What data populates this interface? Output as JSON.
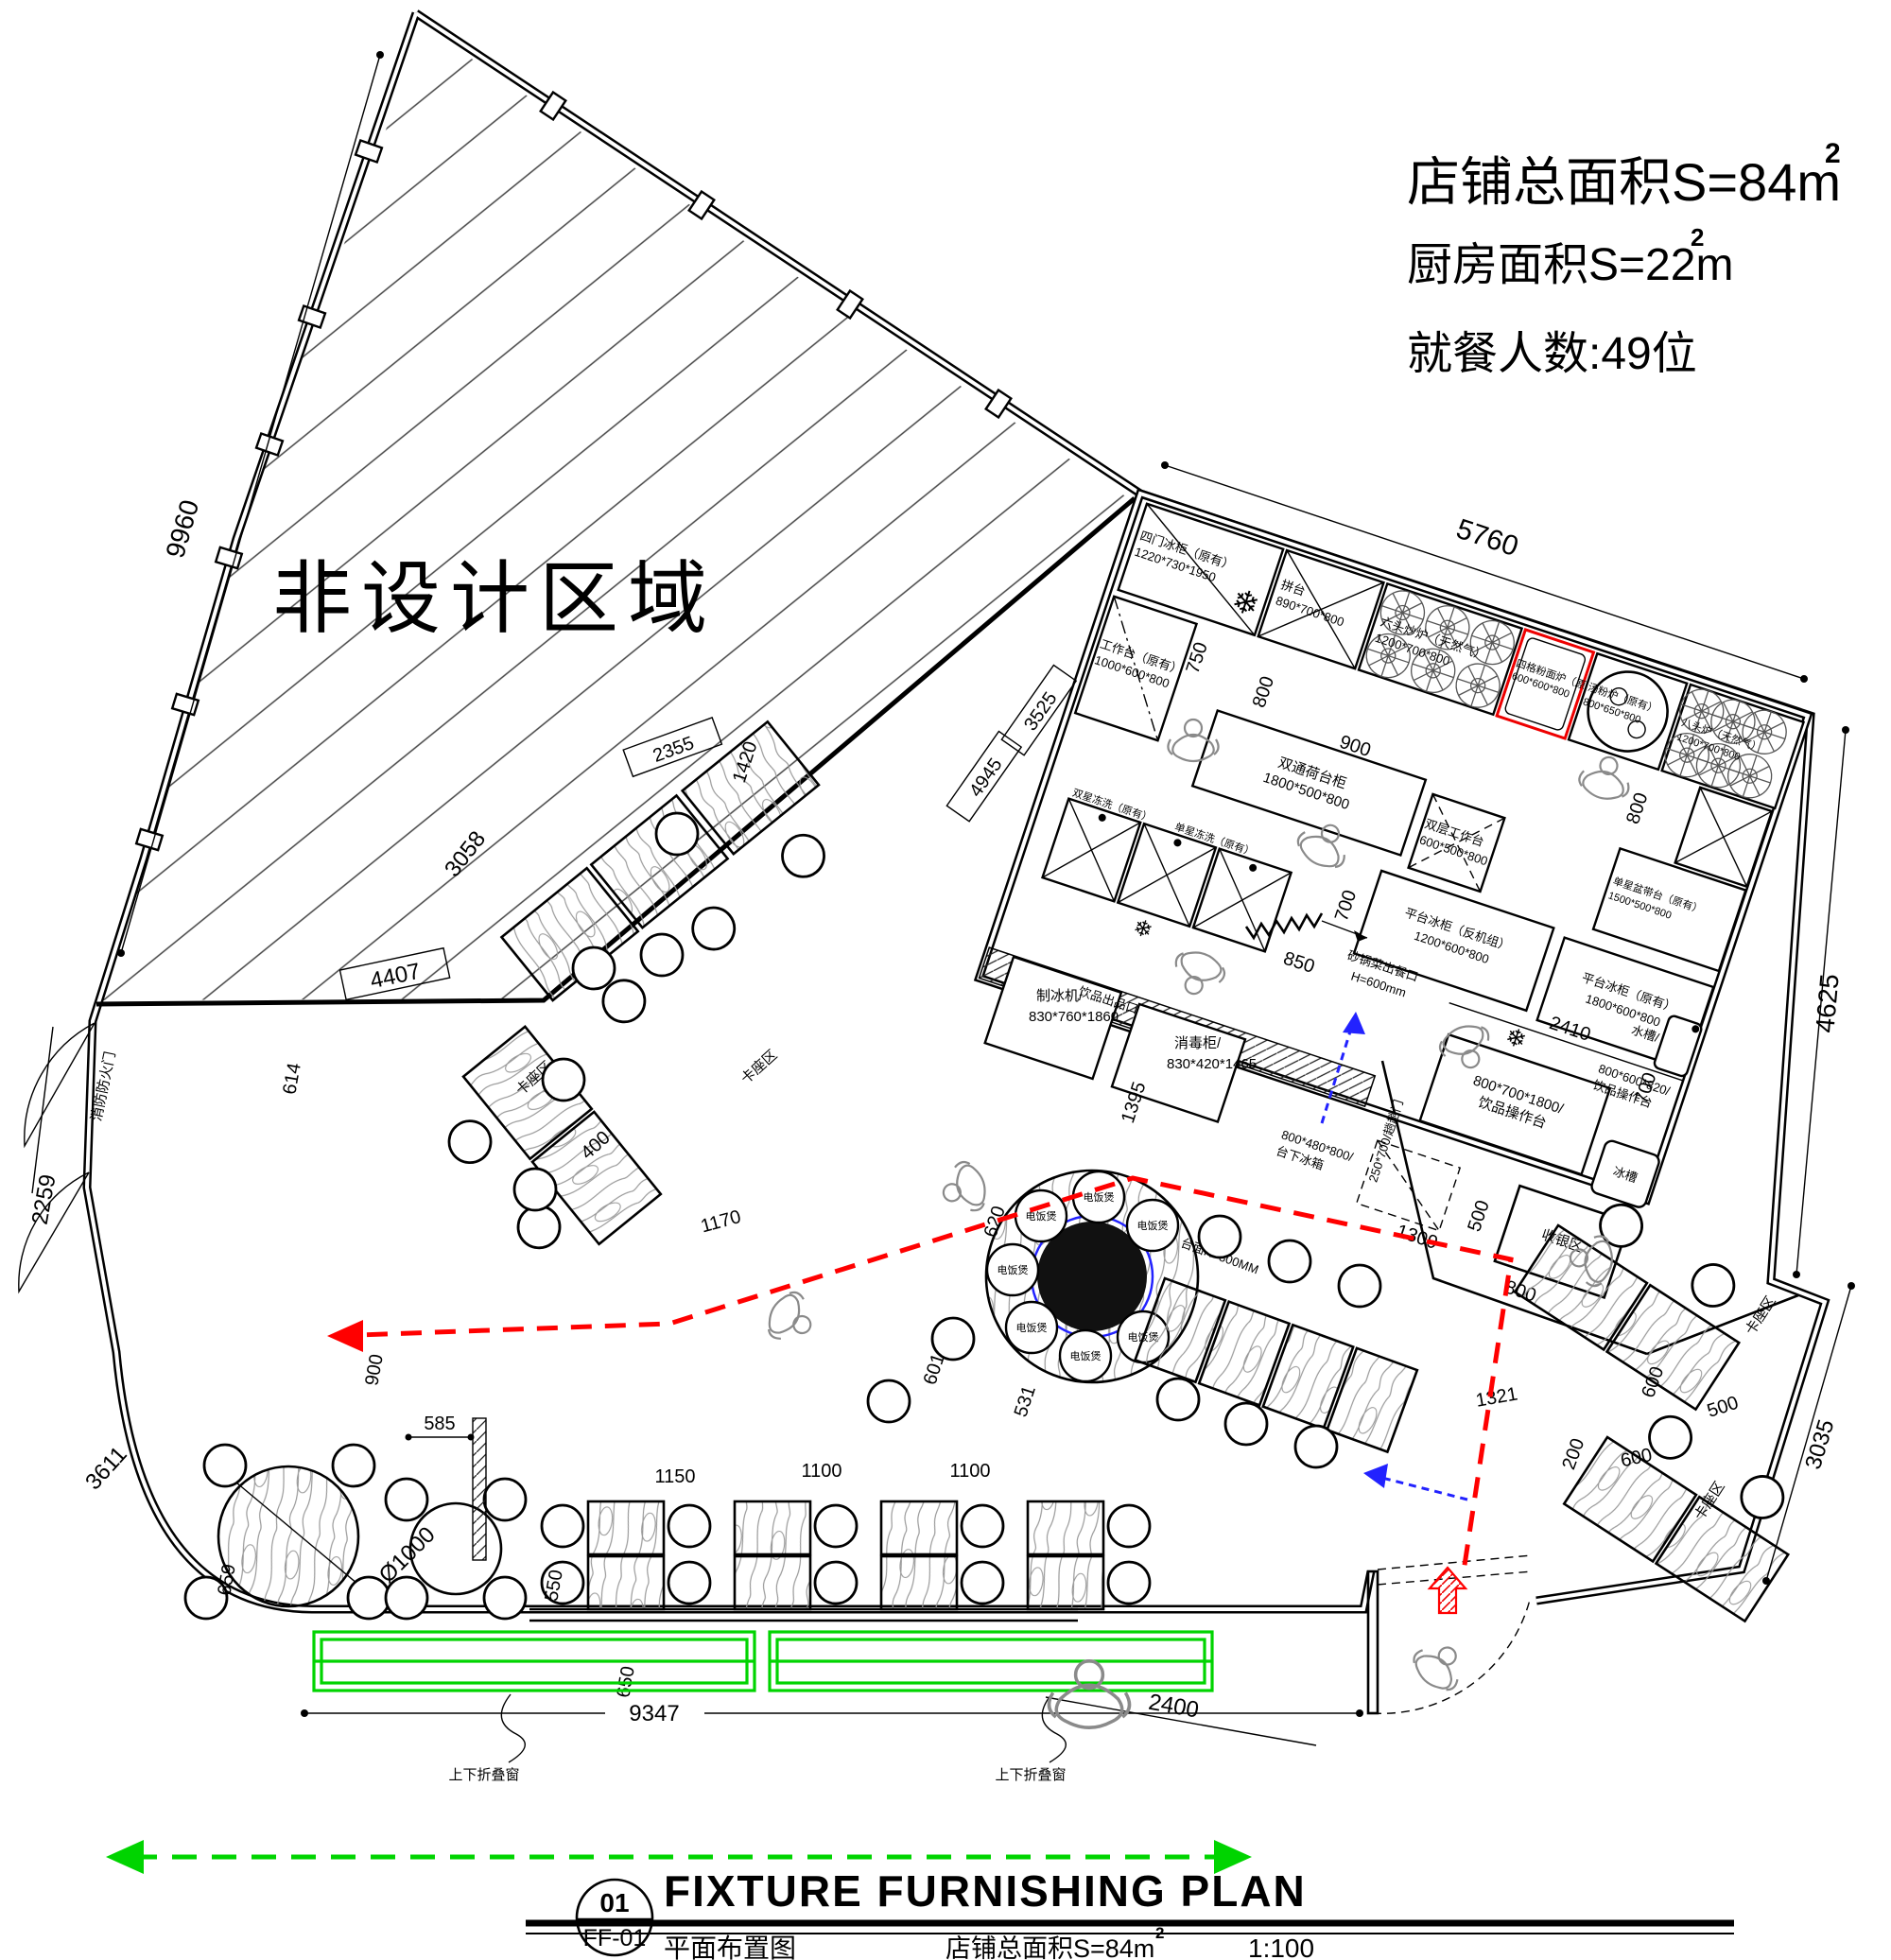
{
  "info_block": {
    "line1": "店铺总面积S=84m",
    "line1_sup": "2",
    "line2": "厨房面积S=22m",
    "line2_sup": "2",
    "line3": "就餐人数:49位"
  },
  "title_block": {
    "number": "01",
    "sheet_no": "FF-01",
    "title_en": "FIXTURE FURNISHING PLAN",
    "title_cn": "平面布置图",
    "area_note": "店铺总面积S=84m",
    "area_note_sup": "2",
    "scale": "1:100"
  },
  "zones": {
    "non_design": "非设计区域",
    "booth": "卡座区",
    "cashier": "收银区",
    "beverage_outlet": "饮品出品口"
  },
  "labels": {
    "fire_door": "消防防火门",
    "folding_window": "上下折叠窗",
    "sliding_door": "250*700/趟趟门",
    "table_top_height": "台面H=800MM",
    "rice_cooker": "电饭煲",
    "serving_window": "砂锅菜出餐口",
    "serving_window_h": "H=600mm"
  },
  "equipment": {
    "four_door_fridge": {
      "name": "四门冰柜（原有）",
      "size": "1220*730*1950"
    },
    "join_table": {
      "name": "拼台",
      "size": "890*700*800"
    },
    "wok_range": {
      "name": "六头炒炉（天然气）",
      "size": "1200*700*800"
    },
    "noodle_cooker": {
      "name": "四格粉面炉（原有）",
      "size": "600*600*800"
    },
    "soup_stove": {
      "name": "汤粉炉（原有）",
      "size": "800*650*800"
    },
    "eight_burner_stove": {
      "name": "八头炉（天然气）",
      "size": "1200*700*800"
    },
    "work_table": {
      "name": "工作台（原有）",
      "size": "1000*600*800"
    },
    "pass_cabinet": {
      "name": "双通荷台柜",
      "size": "1800*500*800"
    },
    "double_work_table": {
      "name": "双层工作台",
      "size": "600*500*800"
    },
    "single_sink_table": {
      "name": "单星盆带台（原有）",
      "size": "1500*500*800"
    },
    "counter_fridge_remote": {
      "name": "平台冰柜（反机组）",
      "size": "1200*600*800"
    },
    "counter_fridge_orig": {
      "name": "平台冰柜（原有）",
      "size": "1800*600*800"
    },
    "ice_maker": {
      "name": "制冰机/",
      "size": "830*760*1860"
    },
    "sterilizer": {
      "name": "消毒柜/",
      "size": "830*420*1465"
    },
    "double_sink": {
      "name": "双星冻洗（原有）"
    },
    "single_sink": {
      "name": "单星冻洗（原有）"
    },
    "water_sink": {
      "name": "水槽/",
      "size": "800*600*820/",
      "size2": "饮品操作台"
    },
    "beverage_counter": {
      "name": "800*700*1800/",
      "size": "饮品操作台"
    },
    "under_counter_fridge": {
      "name": "800*480*800/",
      "size": "台下冰箱"
    },
    "ice_trough": {
      "name": "冰槽"
    }
  },
  "dims": {
    "5760": "5760",
    "4625": "4625",
    "9960": "9960",
    "2259": "2259",
    "3611": "3611",
    "4407": "4407",
    "3058": "3058",
    "2355": "2355",
    "1420": "1420",
    "3525": "3525",
    "4945": "4945",
    "750": "750",
    "800": "800",
    "900": "900",
    "700": "700",
    "850": "850",
    "2410": "2410",
    "1309": "1309",
    "500": "500",
    "3035": "3035",
    "600": "600",
    "200": "200",
    "1321": "1321",
    "614": "614",
    "585": "585",
    "659": "659",
    "d1000": "Ø1000",
    "550": "550",
    "1150": "1150",
    "650": "650",
    "1100": "1100",
    "400": "400",
    "1170": "1170",
    "531": "531",
    "601": "601",
    "620": "620",
    "1395": "1395",
    "9347": "9347",
    "2400": "2400"
  },
  "icons": {
    "snowflake": "❄"
  },
  "colors": {
    "line": "#000000",
    "red": "#ff0000",
    "green": "#00d400",
    "blue": "#2222ff"
  }
}
